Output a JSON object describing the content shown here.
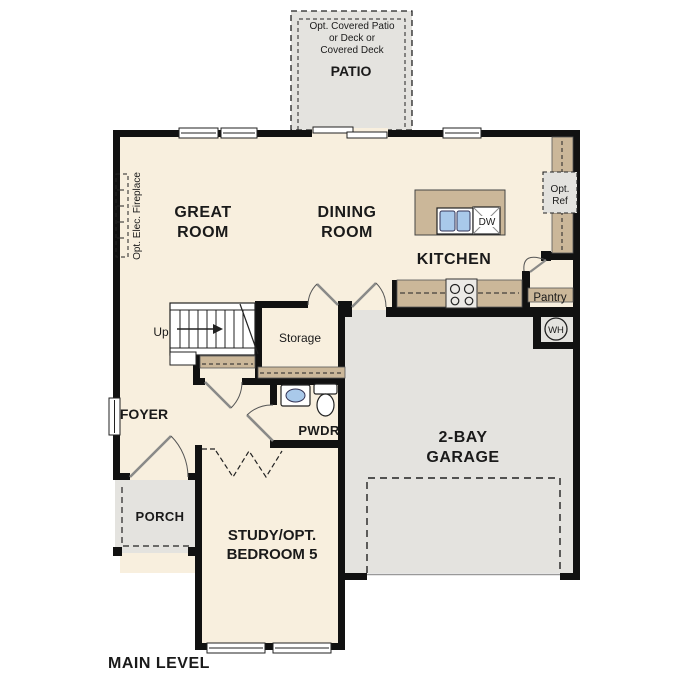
{
  "title": "MAIN LEVEL",
  "patio": {
    "opt_label_line1": "Opt. Covered Patio",
    "opt_label_line2": "or Deck or",
    "opt_label_line3": "Covered Deck",
    "name": "PATIO"
  },
  "rooms": {
    "great_room": {
      "line1": "GREAT",
      "line2": "ROOM"
    },
    "dining_room": {
      "line1": "DINING",
      "line2": "ROOM"
    },
    "kitchen": {
      "label": "KITCHEN"
    },
    "garage": {
      "line1": "2-BAY",
      "line2": "GARAGE"
    },
    "foyer": {
      "label": "FOYER"
    },
    "porch": {
      "label": "PORCH"
    },
    "study": {
      "line1": "STUDY/OPT.",
      "line2": "BEDROOM 5"
    },
    "storage": {
      "label": "Storage"
    },
    "powder": {
      "label": "PWDR"
    }
  },
  "features": {
    "pantry": "Pantry",
    "opt_ref_line1": "Opt.",
    "opt_ref_line2": "Ref",
    "water_heater": "WH",
    "dishwasher": "DW",
    "stairs_up": "Up",
    "fireplace": "Opt. Elec. Fireplace"
  },
  "colors": {
    "floor": "#f8efde",
    "outdoor": "#e4e3df",
    "counter": "#cbb799",
    "wall": "#111111",
    "fixture_blue": "#a9c9ea"
  }
}
